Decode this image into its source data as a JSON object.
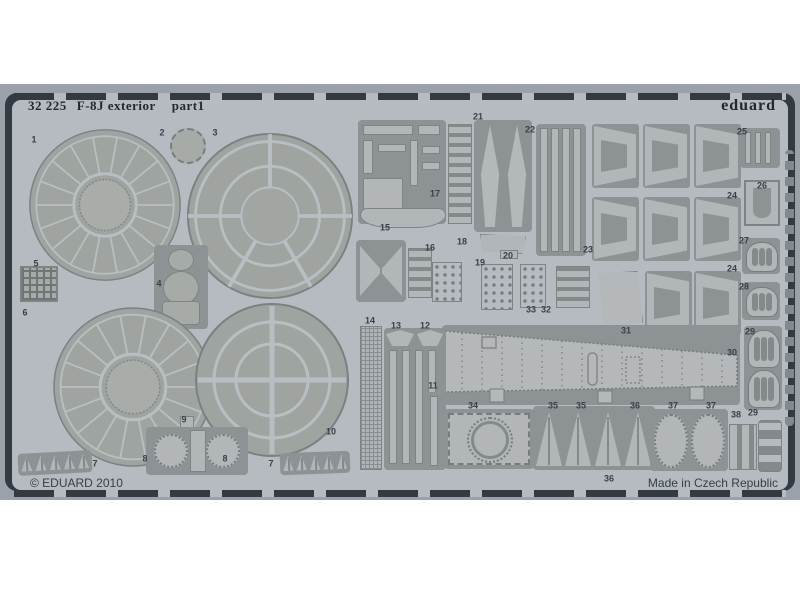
{
  "photo": {
    "brand": "eduard",
    "title_catalog": "32 225",
    "title_name": "F-8J exterior",
    "title_part": "part1",
    "footer_left": "© EDUARD 2010",
    "footer_right": "Made in Czech Republic",
    "colors": {
      "backdrop": "#9aa1a8",
      "frame_gap": "#343a41",
      "sheet": "#b6bbc1",
      "part_fill": "#a7aba8",
      "recess": "#8d9294",
      "etch_line": "#b9bec2",
      "label_text": "#3b4046"
    },
    "part_labels": [
      {
        "n": "1",
        "x": 34,
        "y": 140
      },
      {
        "n": "2",
        "x": 162,
        "y": 133
      },
      {
        "n": "3",
        "x": 215,
        "y": 133
      },
      {
        "n": "5",
        "x": 36,
        "y": 264
      },
      {
        "n": "4",
        "x": 159,
        "y": 284
      },
      {
        "n": "6",
        "x": 25,
        "y": 313
      },
      {
        "n": "7",
        "x": 95,
        "y": 464
      },
      {
        "n": "8",
        "x": 145,
        "y": 459
      },
      {
        "n": "9",
        "x": 184,
        "y": 420
      },
      {
        "n": "8",
        "x": 225,
        "y": 459
      },
      {
        "n": "7",
        "x": 271,
        "y": 464
      },
      {
        "n": "10",
        "x": 331,
        "y": 432
      },
      {
        "n": "14",
        "x": 370,
        "y": 321
      },
      {
        "n": "13",
        "x": 396,
        "y": 326
      },
      {
        "n": "12",
        "x": 425,
        "y": 326
      },
      {
        "n": "11",
        "x": 433,
        "y": 386
      },
      {
        "n": "15",
        "x": 385,
        "y": 228
      },
      {
        "n": "17",
        "x": 435,
        "y": 194
      },
      {
        "n": "16",
        "x": 430,
        "y": 248
      },
      {
        "n": "18",
        "x": 462,
        "y": 242
      },
      {
        "n": "19",
        "x": 480,
        "y": 263
      },
      {
        "n": "20",
        "x": 508,
        "y": 256
      },
      {
        "n": "21",
        "x": 478,
        "y": 117
      },
      {
        "n": "22",
        "x": 530,
        "y": 130
      },
      {
        "n": "23",
        "x": 588,
        "y": 250
      },
      {
        "n": "24",
        "x": 732,
        "y": 196
      },
      {
        "n": "24",
        "x": 732,
        "y": 269
      },
      {
        "n": "25",
        "x": 742,
        "y": 132
      },
      {
        "n": "26",
        "x": 762,
        "y": 186
      },
      {
        "n": "27",
        "x": 744,
        "y": 241
      },
      {
        "n": "28",
        "x": 744,
        "y": 287
      },
      {
        "n": "29",
        "x": 750,
        "y": 332
      },
      {
        "n": "29",
        "x": 753,
        "y": 413
      },
      {
        "n": "30",
        "x": 732,
        "y": 353
      },
      {
        "n": "31",
        "x": 626,
        "y": 331
      },
      {
        "n": "32",
        "x": 546,
        "y": 310
      },
      {
        "n": "33",
        "x": 531,
        "y": 310
      },
      {
        "n": "34",
        "x": 473,
        "y": 406
      },
      {
        "n": "35",
        "x": 553,
        "y": 406
      },
      {
        "n": "35",
        "x": 581,
        "y": 406
      },
      {
        "n": "36",
        "x": 635,
        "y": 406
      },
      {
        "n": "36",
        "x": 609,
        "y": 479
      },
      {
        "n": "37",
        "x": 673,
        "y": 406
      },
      {
        "n": "37",
        "x": 711,
        "y": 406
      },
      {
        "n": "38",
        "x": 736,
        "y": 415
      }
    ]
  }
}
